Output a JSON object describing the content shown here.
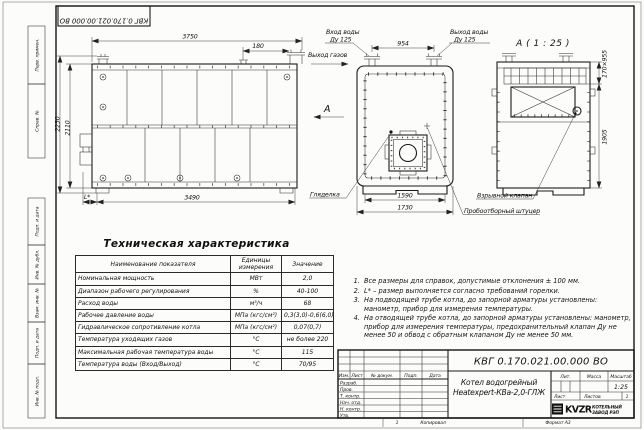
{
  "sheet": {
    "doc_number": "КВГ 0.170.021.00.000 ВО",
    "product_name_line1": "Котел водогрейный",
    "product_name_line2": "Heatexpert-КВа-2,0-ГЛЖ",
    "page_mark": "1",
    "copied_label": "Копировал",
    "format_label": "Формат А3"
  },
  "margin_labels": [
    "Перв. примен.",
    "Справ. №",
    "Подп. и дата",
    "Инв. № дубл.",
    "Взам. инв. №",
    "Подп. и дата",
    "Инв. № подл."
  ],
  "title_block": {
    "cols": [
      "Изм.",
      "Лист",
      "№ докум.",
      "Подп.",
      "Дата"
    ],
    "rows": [
      "Разраб.",
      "Пров.",
      "Т. контр.",
      "Нач. отд.",
      "Н. контр.",
      "Утв."
    ],
    "lit_label": "Лит.",
    "mass_label": "Масса",
    "scale_label": "Масштаб",
    "scale_value": "1:25",
    "sheet_label": "Лист",
    "sheets_label": "Листов",
    "sheets_value": "1",
    "logo_text": "KVZR",
    "logo_caption_line1": "КОТЕЛЬНЫЙ",
    "logo_caption_line2": "ЗАВОД РЭП"
  },
  "views": {
    "side": {
      "dim_top": "3750",
      "dim_chimney": "180",
      "dim_height_outer": "2230",
      "dim_height_inner": "2110",
      "dim_bottom": "3490",
      "dim_burner": "L*"
    },
    "front": {
      "label_water_in": "Вход воды",
      "label_water_in_dn": "Ду 125",
      "label_water_out": "Выход воды",
      "label_water_out_dn": "Ду 125",
      "label_gas_out": "Выход газов",
      "label_sight_glass": "Гляделка",
      "view_letter": "А",
      "dim_nozzle_spacing": "954",
      "dim_width_inner": "1590",
      "dim_width_outer": "1730"
    },
    "section": {
      "title": "А ( 1 : 25 )",
      "label_explosion_valve": "Взрывной клапан",
      "label_sampling_fitting": "Пробоотборный штуцер",
      "dim_window": "170×955",
      "dim_height": "1905"
    }
  },
  "spec_table": {
    "title": "Техническая характеристика",
    "headers": [
      "Наименование показателя",
      "Единицы измерения",
      "Значение"
    ],
    "rows": [
      [
        "Номинальная мощность",
        "МВт",
        "2,0"
      ],
      [
        "Диапазон рабочего регулирования",
        "%",
        "40-100"
      ],
      [
        "Расход воды",
        "м³/ч",
        "68"
      ],
      [
        "Рабочее давление воды",
        "МПа (кгс/см²)",
        "0,3(3,0)-0,6(6,0)"
      ],
      [
        "Гидравлическое сопротивление котла",
        "МПа (кгс/см²)",
        "0,07(0,7)"
      ],
      [
        "Температура уходящих газов",
        "°С",
        "не более 220"
      ],
      [
        "Максимальная рабочая температура воды",
        "°С",
        "115"
      ],
      [
        "Температура воды (Вход/Выход)",
        "°С",
        "70/95"
      ]
    ]
  },
  "notes": [
    "Все размеры для справок, допустимые отклонения ± 100 мм.",
    "L* – размер выполняется согласно требований горелки.",
    "На подводящей трубе котла, до запорной арматуры установлены: манометр, прибор для измерения температуры.",
    "На отводящей трубе котла, до запорной арматуры установлены: манометр, прибор для измерения температуры, предохранительный клапан Ду не менее 50 и обвод с обратным клапаном Ду не менее 50 мм."
  ]
}
